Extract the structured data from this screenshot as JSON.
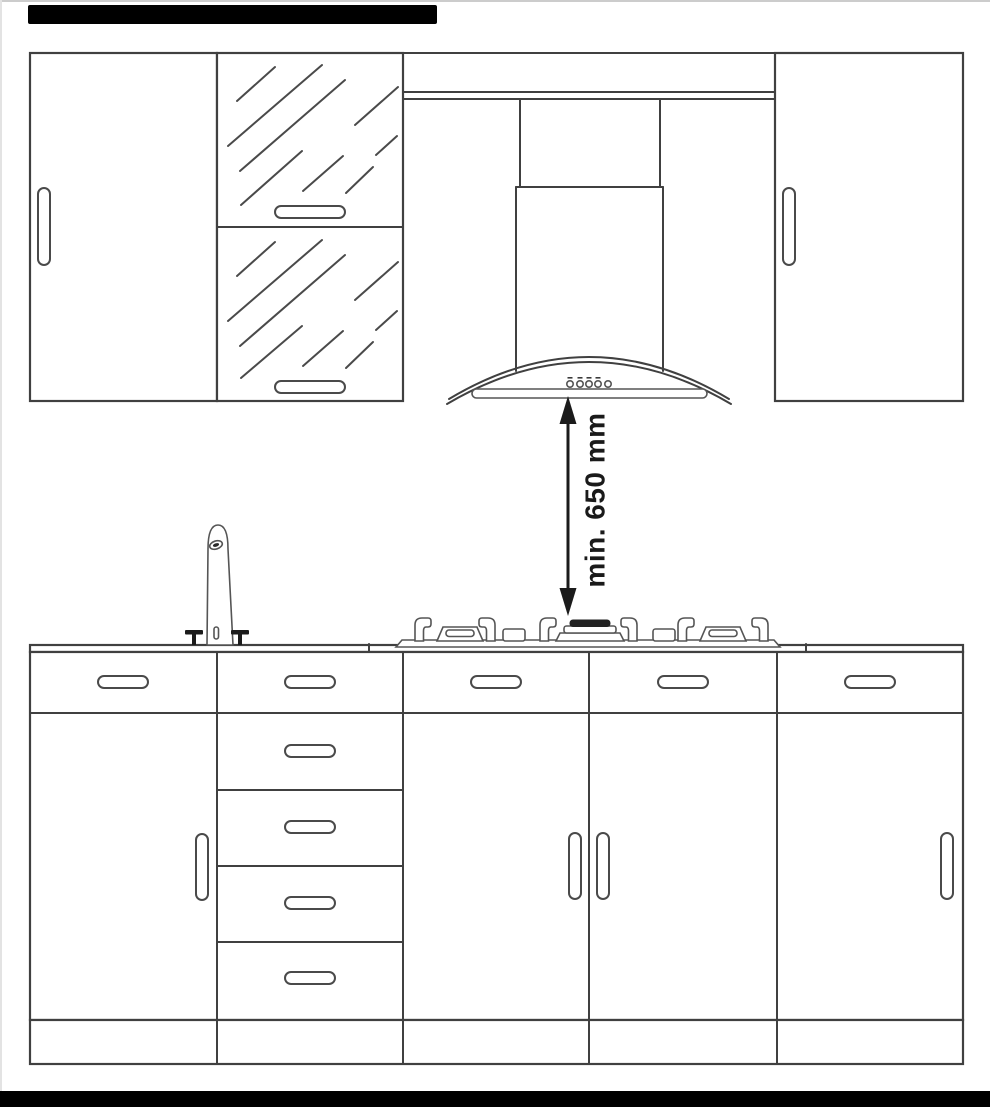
{
  "annotation": {
    "dimension_label": "min. 650 mm"
  },
  "hood": {
    "button_count": "5"
  },
  "colors": {
    "background": "#ffffff",
    "line": "#404040",
    "annotation": "#1a1a1a",
    "scan_bar": "#000000"
  }
}
